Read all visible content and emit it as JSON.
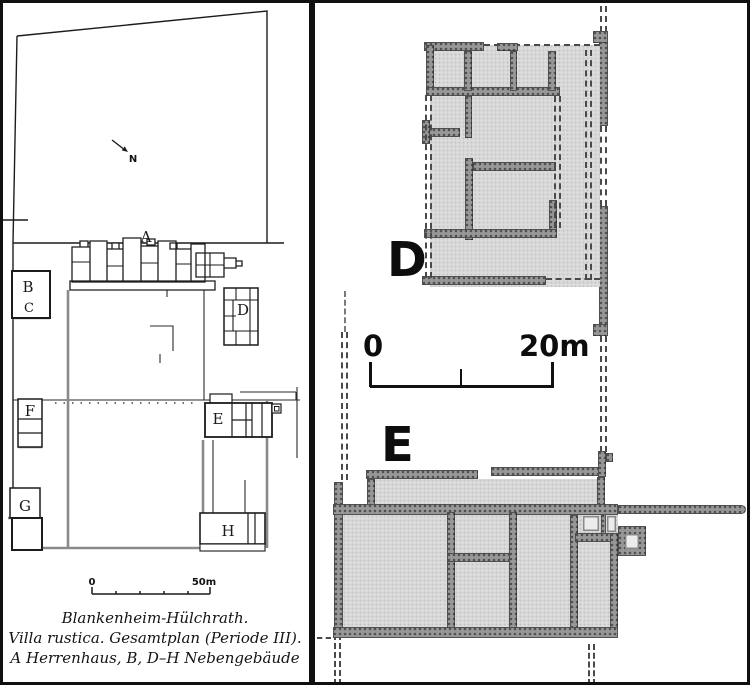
{
  "left": {
    "north": "N",
    "buildings": {
      "A": "A",
      "B": "B",
      "C": "C",
      "D": "D",
      "E": "E",
      "F": "F",
      "G": "G",
      "H": "H"
    },
    "scale": {
      "zero": "0",
      "end": "50m"
    },
    "caption": [
      "Blankenheim-Hülchrath.",
      "Villa rustica. Gesamtplan (Periode III).",
      "A Herrenhaus, B, D–H Nebengebäude"
    ]
  },
  "right": {
    "labels": {
      "D": "D",
      "E": "E"
    },
    "scale": {
      "zero": "0",
      "end": "20m"
    }
  },
  "colors": {
    "ink": "#1a1a1a",
    "gray_wall": "#8a8a8a",
    "fill_light": "#dcdcdc",
    "wall_dark": "#979797",
    "dash": "#4a4a4a"
  }
}
